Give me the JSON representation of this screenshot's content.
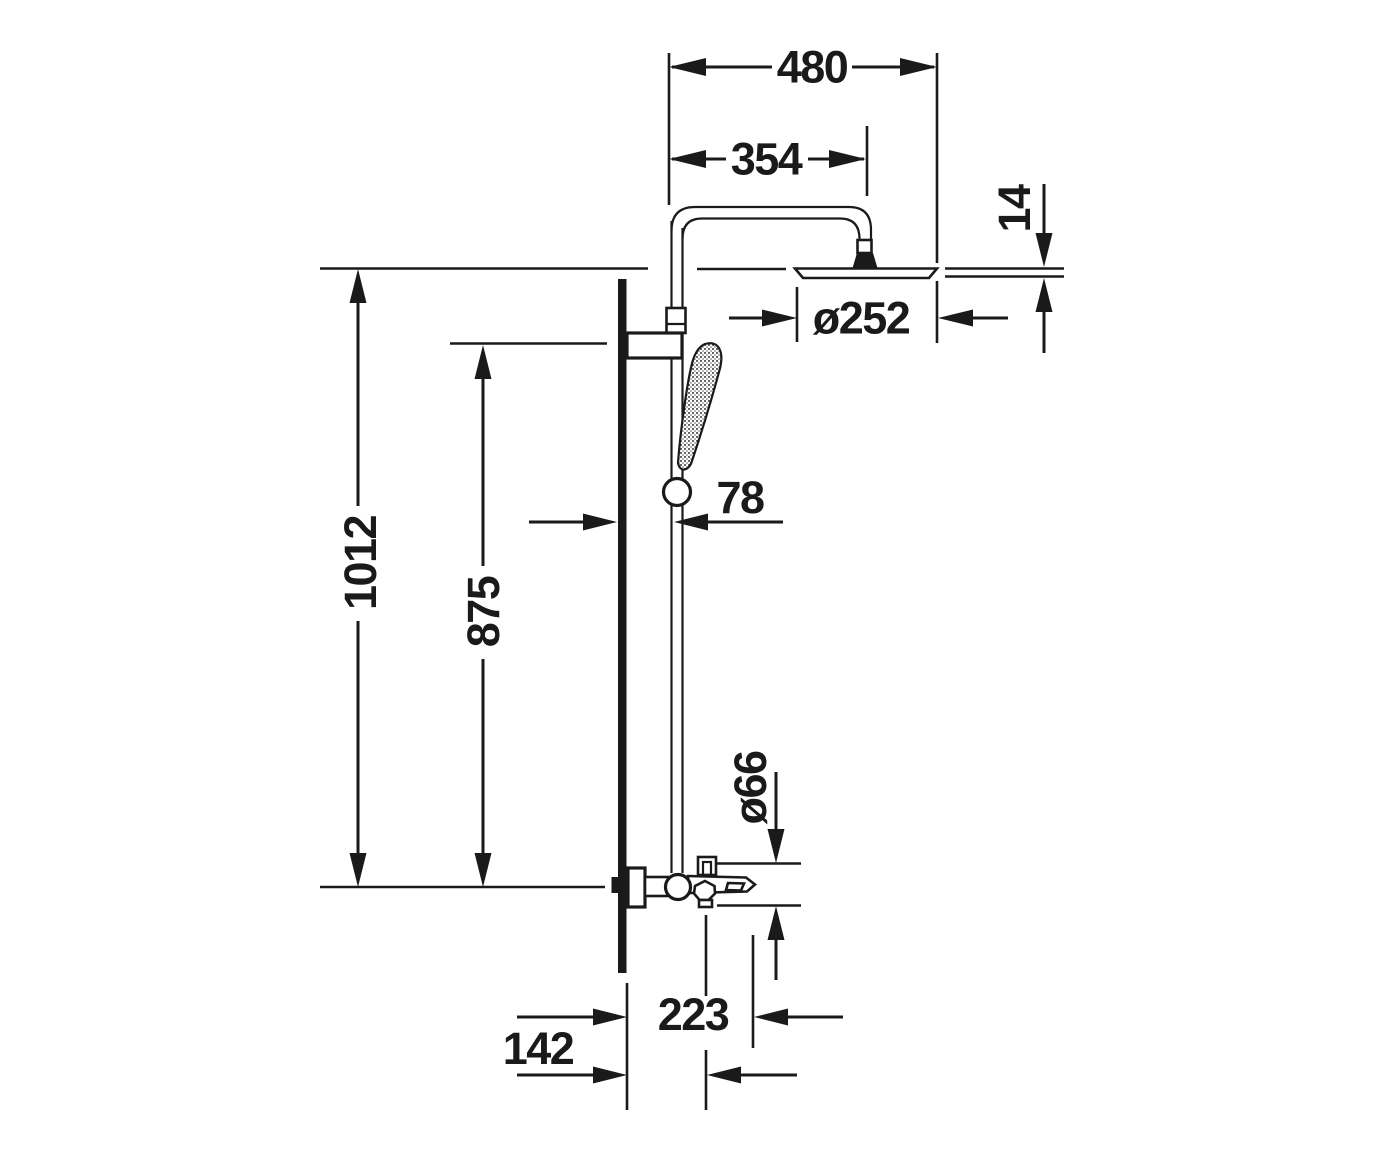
{
  "drawing": {
    "type": "technical-dimension-drawing",
    "subject": "Shower column with overhead shower, hand shower rail and bath mixer - side elevation",
    "units": "mm",
    "colors": {
      "line": "#1a1a1a",
      "background": "#ffffff"
    },
    "labels": {
      "width_overall": "480",
      "arm_reach": "354",
      "head_edge_thickness": "14",
      "head_diameter": "ø252",
      "wall_to_rail": "78",
      "height_overall": "1012",
      "height_rail_bracket": "875",
      "valve_diameter": "ø66",
      "wall_to_spout_tip": "223",
      "wall_to_handle": "142"
    }
  }
}
